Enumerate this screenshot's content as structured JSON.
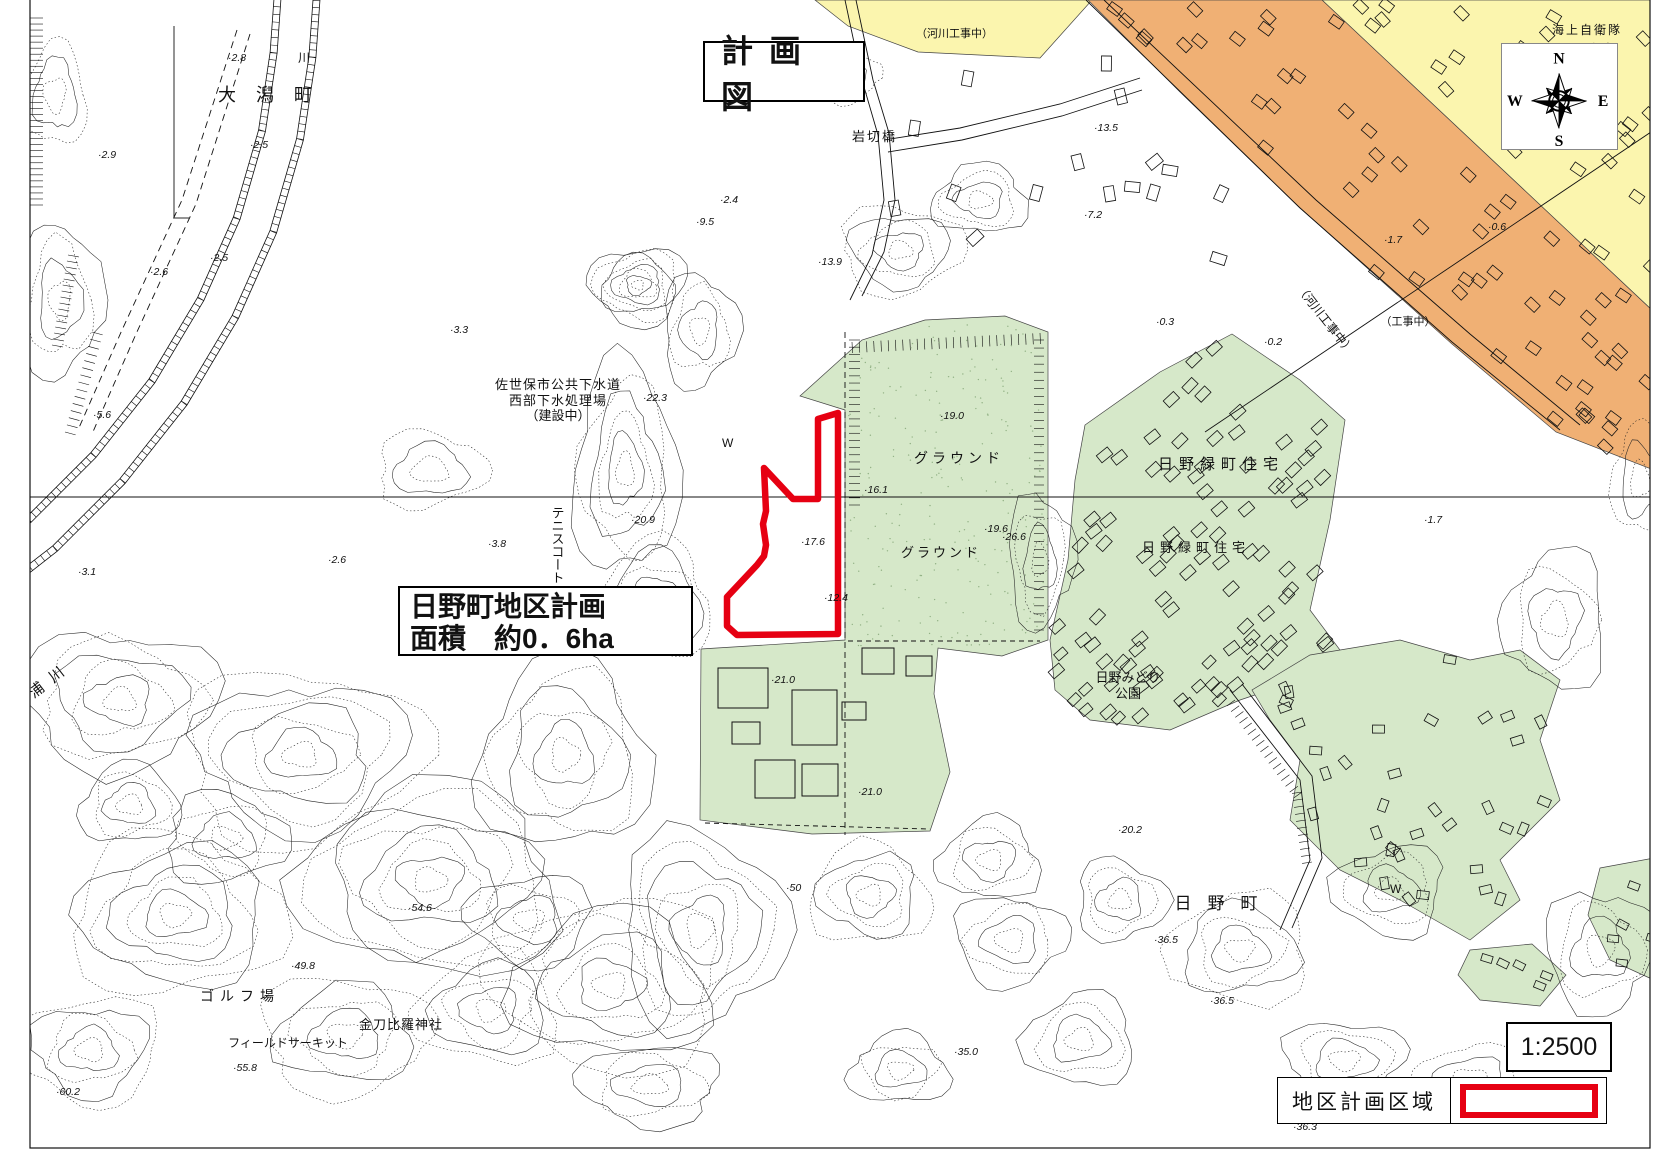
{
  "page": {
    "background": "#ffffff"
  },
  "title_box": {
    "text": "計画図"
  },
  "district_callout": {
    "line1": "日野町地区計画",
    "line2": "面積　約0．6ha"
  },
  "scale_box": {
    "text": "1:2500"
  },
  "legend": {
    "label": "地区計画区域"
  },
  "compass": {
    "n": "N",
    "e": "E",
    "s": "S",
    "w": "W"
  },
  "colors": {
    "district_red": "#e60012",
    "area_green": "#d6e8c9",
    "area_orange": "#f0b074",
    "area_yellow": "#fbf5ae",
    "line": "#1b1b1b"
  },
  "district_polygon": [
    [
      818,
      419
    ],
    [
      838,
      413
    ],
    [
      838,
      634
    ],
    [
      737,
      635
    ],
    [
      727,
      626
    ],
    [
      727,
      597
    ],
    [
      757,
      565
    ],
    [
      764,
      556
    ],
    [
      766,
      545
    ],
    [
      763,
      524
    ],
    [
      766,
      511
    ],
    [
      764,
      468
    ],
    [
      793,
      499
    ],
    [
      818,
      499
    ]
  ],
  "map_labels": [
    {
      "t": "大潟町",
      "x": 218,
      "y": 101,
      "s": 18,
      "ls": 20
    },
    {
      "t": "川",
      "x": 298,
      "y": 62,
      "s": 12
    },
    {
      "t": "相浦川",
      "x": 14,
      "y": 714,
      "s": 15,
      "r": -38,
      "ls": 10
    },
    {
      "t": "岩切橋",
      "x": 852,
      "y": 141,
      "s": 13,
      "ls": 2
    },
    {
      "t": "（河川工事中）",
      "x": 916,
      "y": 37,
      "s": 11
    },
    {
      "t": "佐世保市公共下水道",
      "x": 558,
      "y": 389,
      "s": 13,
      "a": "middle",
      "ls": 1
    },
    {
      "t": "西部下水処理場",
      "x": 558,
      "y": 405,
      "s": 13,
      "a": "middle",
      "ls": 1
    },
    {
      "t": "（建設中）",
      "x": 558,
      "y": 420,
      "s": 13,
      "a": "middle"
    },
    {
      "t": "テニスコート",
      "x": 557,
      "y": 506,
      "s": 13,
      "v": 1
    },
    {
      "t": "グラウンド",
      "x": 959,
      "y": 463,
      "s": 14,
      "a": "middle",
      "ls": 4
    },
    {
      "t": "グラウンド",
      "x": 941,
      "y": 557,
      "s": 13,
      "a": "middle",
      "ls": 3
    },
    {
      "t": "日野緑町住宅",
      "x": 1221,
      "y": 469,
      "s": 15,
      "a": "middle",
      "ls": 6
    },
    {
      "t": "日野緑町住宅",
      "x": 1196,
      "y": 552,
      "s": 13,
      "a": "middle",
      "ls": 5
    },
    {
      "t": "日野みどり",
      "x": 1128,
      "y": 682,
      "s": 13,
      "a": "middle"
    },
    {
      "t": "公園",
      "x": 1128,
      "y": 698,
      "s": 13,
      "a": "middle"
    },
    {
      "t": "日野町",
      "x": 1224,
      "y": 909,
      "s": 17,
      "a": "middle",
      "ls": 16
    },
    {
      "t": "ゴルフ場",
      "x": 240,
      "y": 1001,
      "s": 14,
      "a": "middle",
      "ls": 6
    },
    {
      "t": "金刀比羅神社",
      "x": 401,
      "y": 1029,
      "s": 13,
      "a": "middle",
      "ls": 1
    },
    {
      "t": "フィールドサーキット",
      "x": 288,
      "y": 1047,
      "s": 12,
      "a": "middle"
    },
    {
      "t": "（河川工事中）",
      "x": 1322,
      "y": 322,
      "s": 12,
      "a": "middle",
      "r": 52
    },
    {
      "t": "（工事中）",
      "x": 1408,
      "y": 325,
      "s": 11,
      "a": "middle"
    },
    {
      "t": "海上自衛隊",
      "x": 1552,
      "y": 34,
      "s": 12,
      "ls": 2
    },
    {
      "t": "宿舎",
      "x": 1588,
      "y": 53,
      "s": 12,
      "ls": 2
    },
    {
      "t": "W",
      "x": 722,
      "y": 447,
      "s": 12
    },
    {
      "t": "W",
      "x": 1390,
      "y": 893,
      "s": 12
    }
  ],
  "spot_elevations": [
    [
      228,
      61,
      "2.8"
    ],
    [
      250,
      148,
      "2.5"
    ],
    [
      98,
      158,
      "2.9"
    ],
    [
      210,
      261,
      "2.5"
    ],
    [
      150,
      275,
      "2.6"
    ],
    [
      93,
      418,
      "5.6"
    ],
    [
      78,
      575,
      "3.1"
    ],
    [
      328,
      563,
      "2.6"
    ],
    [
      450,
      333,
      "3.3"
    ],
    [
      488,
      547,
      "3.8"
    ],
    [
      720,
      203,
      "2.4"
    ],
    [
      696,
      225,
      "9.5"
    ],
    [
      818,
      265,
      "13.9"
    ],
    [
      643,
      401,
      "22.3"
    ],
    [
      631,
      523,
      "20.9"
    ],
    [
      801,
      545,
      "17.6"
    ],
    [
      864,
      493,
      "16.1"
    ],
    [
      940,
      419,
      "19.0"
    ],
    [
      984,
      532,
      "19.6"
    ],
    [
      1002,
      540,
      "26.6"
    ],
    [
      824,
      601,
      "12.4"
    ],
    [
      771,
      683,
      "21.0"
    ],
    [
      858,
      795,
      "21.0"
    ],
    [
      1094,
      131,
      "13.5"
    ],
    [
      1084,
      218,
      "7.2"
    ],
    [
      1156,
      325,
      "0.3"
    ],
    [
      1264,
      345,
      "0.2"
    ],
    [
      1384,
      243,
      "1.7"
    ],
    [
      1488,
      230,
      "0.6"
    ],
    [
      1424,
      523,
      "1.7"
    ],
    [
      1118,
      833,
      "20.2"
    ],
    [
      1154,
      943,
      "36.5"
    ],
    [
      291,
      969,
      "49.8"
    ],
    [
      408,
      911,
      "54.6"
    ],
    [
      233,
      1071,
      "55.8"
    ],
    [
      56,
      1095,
      "60.2"
    ],
    [
      954,
      1055,
      "35.0"
    ],
    [
      1210,
      1004,
      "36.5"
    ],
    [
      1293,
      1130,
      "36.3"
    ],
    [
      786,
      891,
      "50"
    ]
  ]
}
